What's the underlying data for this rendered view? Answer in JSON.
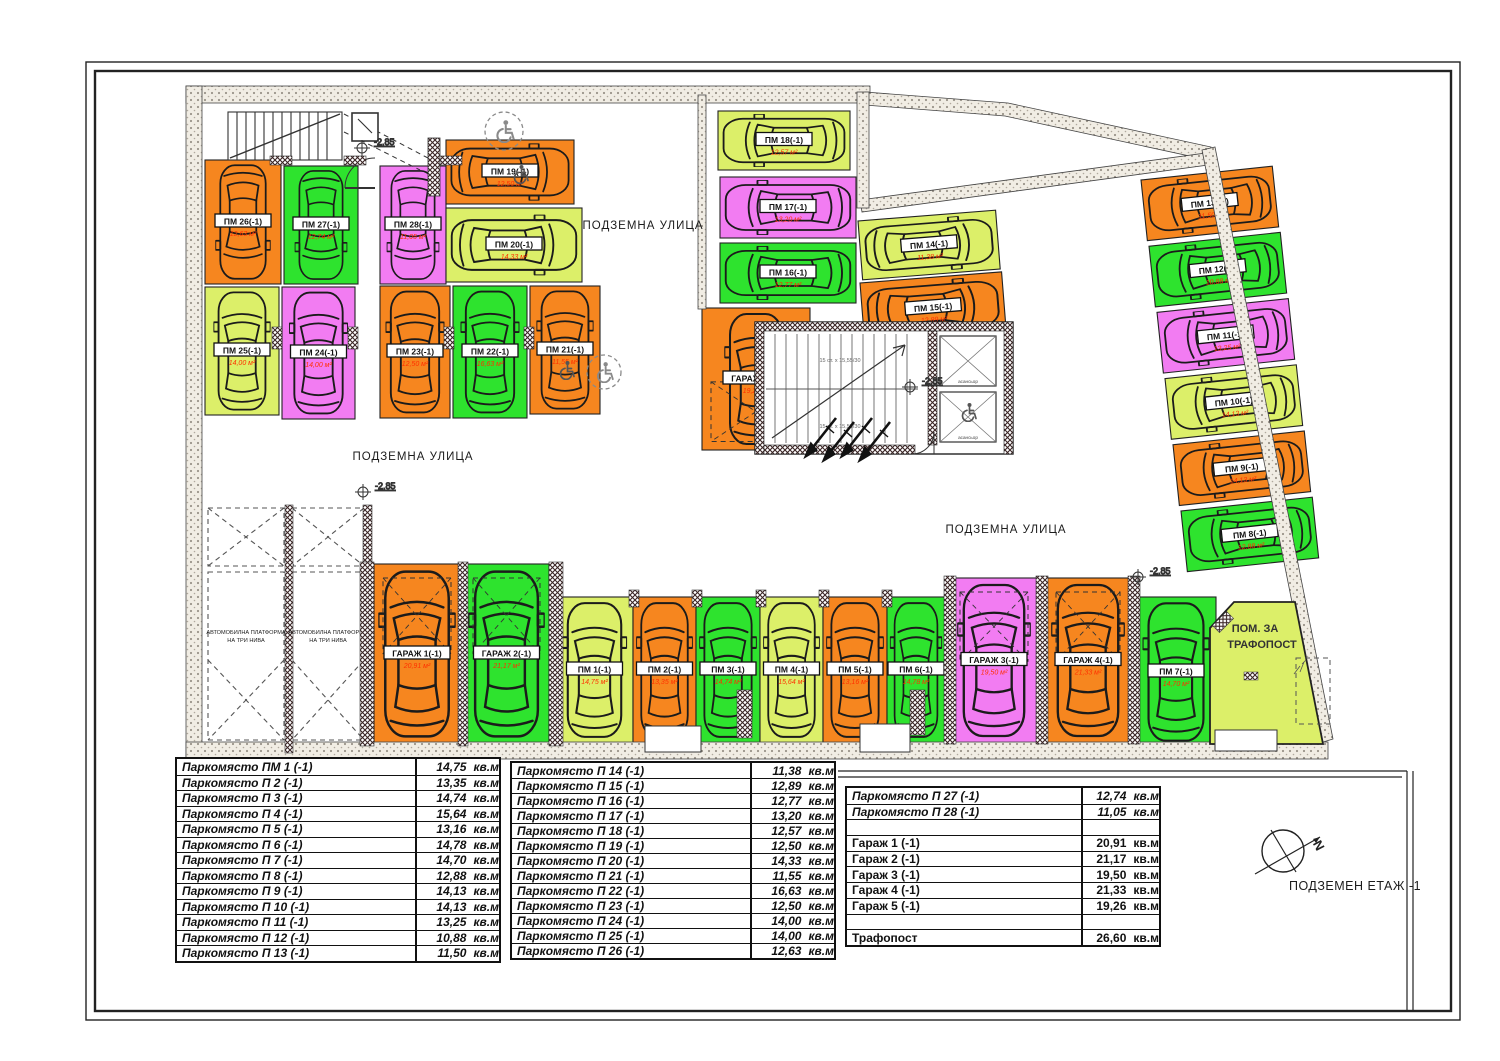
{
  "plan": {
    "street_label": "ПОДЗЕМНА УЛИЦА",
    "level_marker": "-2.85",
    "floor_label": "ПОДЗЕМЕН  ЕТАЖ -1",
    "compass_north": "N",
    "trafo_room_line1": "ПОМ. ЗА",
    "trafo_room_line2": "ТРАФОПОСТ",
    "platform_line1": "АВТОМОБИЛНА ПЛАТФОРМА",
    "platform_line2": "НА ТРИ НИВА",
    "elevator_label": "асансьор",
    "stair_note": "15 ст. х 15,55/30",
    "spaces": [
      {
        "id": "pm1",
        "label": "ПМ 1(-1)",
        "area": "14,75 м²",
        "color": "yellowgreen"
      },
      {
        "id": "pm2",
        "label": "ПМ 2(-1)",
        "area": "13,35 м²",
        "color": "orange"
      },
      {
        "id": "pm3",
        "label": "ПМ 3(-1)",
        "area": "14,74 м²",
        "color": "green"
      },
      {
        "id": "pm4",
        "label": "ПМ 4(-1)",
        "area": "15,64 м²",
        "color": "yellowgreen"
      },
      {
        "id": "pm5",
        "label": "ПМ 5(-1)",
        "area": "13,16 м²",
        "color": "orange"
      },
      {
        "id": "pm6",
        "label": "ПМ 6(-1)",
        "area": "14,78 м²",
        "color": "green"
      },
      {
        "id": "pm7",
        "label": "ПМ 7(-1)",
        "area": "14,70 м²",
        "color": "green"
      },
      {
        "id": "pm8",
        "label": "ПМ 8(-1)",
        "area": "12,88 м²",
        "color": "green"
      },
      {
        "id": "pm9",
        "label": "ПМ 9(-1)",
        "area": "14,13 м²",
        "color": "orange"
      },
      {
        "id": "pm10",
        "label": "ПМ 10(-1)",
        "area": "14,13 м²",
        "color": "yellowgreen"
      },
      {
        "id": "pm11",
        "label": "ПМ 11(-1)",
        "area": "13,25 м²",
        "color": "magenta"
      },
      {
        "id": "pm12",
        "label": "ПМ 12(-1)",
        "area": "10,88 м²",
        "color": "green"
      },
      {
        "id": "pm13",
        "label": "ПМ 13(-1)",
        "area": "11,50 м²",
        "color": "orange"
      },
      {
        "id": "pm14",
        "label": "ПМ 14(-1)",
        "area": "11,38 м²",
        "color": "yellowgreen"
      },
      {
        "id": "pm15",
        "label": "ПМ 15(-1)",
        "area": "12,89 м²",
        "color": "orange"
      },
      {
        "id": "pm16",
        "label": "ПМ 16(-1)",
        "area": "12,77 м²",
        "color": "green"
      },
      {
        "id": "pm17",
        "label": "ПМ 17(-1)",
        "area": "13,20 м²",
        "color": "magenta"
      },
      {
        "id": "pm18",
        "label": "ПМ 18(-1)",
        "area": "12,57 м²",
        "color": "yellowgreen"
      },
      {
        "id": "pm19",
        "label": "ПМ 19(-1)",
        "area": "12,50 м²",
        "color": "orange"
      },
      {
        "id": "pm20",
        "label": "ПМ 20(-1)",
        "area": "14,33 м²",
        "color": "yellowgreen"
      },
      {
        "id": "pm21",
        "label": "ПМ 21(-1)",
        "area": "11,55 м²",
        "color": "orange"
      },
      {
        "id": "pm22",
        "label": "ПМ 22(-1)",
        "area": "16,63 м²",
        "color": "green"
      },
      {
        "id": "pm23",
        "label": "ПМ 23(-1)",
        "area": "12,50 м²",
        "color": "orange"
      },
      {
        "id": "pm24",
        "label": "ПМ 24(-1)",
        "area": "14,00 м²",
        "color": "magenta"
      },
      {
        "id": "pm25",
        "label": "ПМ 25(-1)",
        "area": "14,00 м²",
        "color": "yellowgreen"
      },
      {
        "id": "pm26",
        "label": "ПМ 26(-1)",
        "area": "12,63 м²",
        "color": "orange"
      },
      {
        "id": "pm27",
        "label": "ПМ 27(-1)",
        "area": "12,74 м²",
        "color": "green"
      },
      {
        "id": "pm28",
        "label": "ПМ 28(-1)",
        "area": "11,05 м²",
        "color": "magenta"
      },
      {
        "id": "g1",
        "label": "ГАРАЖ 1(-1)",
        "area": "20,91 м²",
        "color": "orange"
      },
      {
        "id": "g2",
        "label": "ГАРАЖ 2(-1)",
        "area": "21,17 м²",
        "color": "green"
      },
      {
        "id": "g3",
        "label": "ГАРАЖ 3(-1)",
        "area": "19,50 м²",
        "color": "magenta"
      },
      {
        "id": "g4",
        "label": "ГАРАЖ 4(-1)",
        "area": "21,33 м²",
        "color": "orange"
      },
      {
        "id": "g5",
        "label": "ГАРАЖ 5(-1)",
        "area": "19,26 м²",
        "color": "orange"
      }
    ]
  },
  "tables": {
    "unit": "кв.м",
    "t1": [
      {
        "n": "Паркомясто ПМ 1 (-1)",
        "v": "14,75"
      },
      {
        "n": "Паркомясто П 2 (-1)",
        "v": "13,35"
      },
      {
        "n": "Паркомясто П 3 (-1)",
        "v": "14,74"
      },
      {
        "n": "Паркомясто П 4 (-1)",
        "v": "15,64"
      },
      {
        "n": "Паркомясто П 5 (-1)",
        "v": "13,16"
      },
      {
        "n": "Паркомясто П 6 (-1)",
        "v": "14,78"
      },
      {
        "n": "Паркомясто П 7 (-1)",
        "v": "14,70"
      },
      {
        "n": "Паркомясто П 8 (-1)",
        "v": "12,88"
      },
      {
        "n": "Паркомясто П 9 (-1)",
        "v": "14,13"
      },
      {
        "n": "Паркомясто П 10 (-1)",
        "v": "14,13"
      },
      {
        "n": "Паркомясто П 11 (-1)",
        "v": "13,25"
      },
      {
        "n": "Паркомясто П 12 (-1)",
        "v": "10,88"
      },
      {
        "n": "Паркомясто П 13 (-1)",
        "v": "11,50"
      }
    ],
    "t2": [
      {
        "n": "Паркомясто П 14 (-1)",
        "v": "11,38"
      },
      {
        "n": "Паркомясто П 15 (-1)",
        "v": "12,89"
      },
      {
        "n": "Паркомясто П 16 (-1)",
        "v": "12,77"
      },
      {
        "n": "Паркомясто П 17 (-1)",
        "v": "13,20"
      },
      {
        "n": "Паркомясто П 18 (-1)",
        "v": "12,57"
      },
      {
        "n": "Паркомясто П 19 (-1)",
        "v": "12,50"
      },
      {
        "n": "Паркомясто П 20 (-1)",
        "v": "14,33"
      },
      {
        "n": "Паркомясто П 21 (-1)",
        "v": "11,55"
      },
      {
        "n": "Паркомясто П 22 (-1)",
        "v": "16,63"
      },
      {
        "n": "Паркомясто П 23 (-1)",
        "v": "12,50"
      },
      {
        "n": "Паркомясто П 24 (-1)",
        "v": "14,00"
      },
      {
        "n": "Паркомясто П 25 (-1)",
        "v": "14,00"
      },
      {
        "n": "Паркомясто П 26 (-1)",
        "v": "12,63"
      }
    ],
    "t3": [
      {
        "n": "Паркомясто П 27 (-1)",
        "v": "12,74"
      },
      {
        "n": "Паркомясто П 28 (-1)",
        "v": "11,05"
      },
      {
        "n": "",
        "v": ""
      },
      {
        "n": "Гараж 1 (-1)",
        "v": "20,91"
      },
      {
        "n": "Гараж 2 (-1)",
        "v": "21,17"
      },
      {
        "n": "Гараж 3 (-1)",
        "v": "19,50"
      },
      {
        "n": "Гараж 4 (-1)",
        "v": "21,33"
      },
      {
        "n": "Гараж 5 (-1)",
        "v": "19,26"
      },
      {
        "n": "",
        "v": ""
      },
      {
        "n": "Трафопост",
        "v": "26,60"
      }
    ]
  },
  "colors": {
    "orange": "#F6861F",
    "green": "#2EE32E",
    "magenta": "#F27CF2",
    "yellowgreen": "#DCEF69",
    "area_text": "#FF3000",
    "line": "#1a1a1a"
  }
}
